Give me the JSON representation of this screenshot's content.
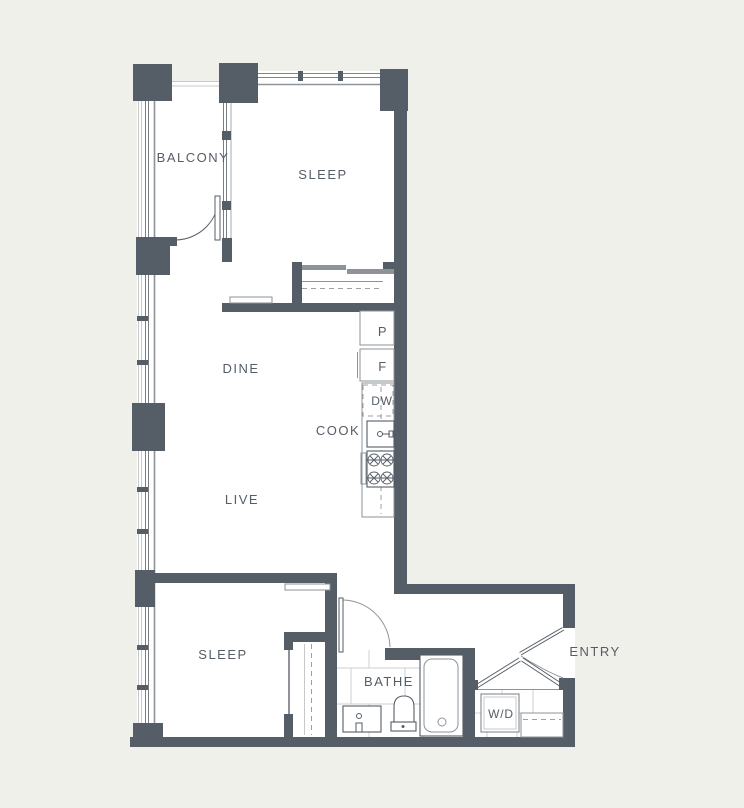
{
  "rooms": {
    "balcony": "BALCONY",
    "sleep_upper": "SLEEP",
    "dine": "DINE",
    "cook": "COOK",
    "live": "LIVE",
    "sleep_lower": "SLEEP",
    "bathe": "BATHE",
    "entry": "ENTRY"
  },
  "appliances": {
    "pantry": "P",
    "refrigerator": "F",
    "dishwasher": "DW",
    "washer_dryer": "W/D"
  },
  "colors": {
    "wall": "#555d66",
    "background": "#f0f0ea",
    "floor": "#ffffff",
    "line-light": "#c7c9cc",
    "line-mid": "#8e939a",
    "tile": "#cdcfd2",
    "dash": "#9ba0a6"
  }
}
